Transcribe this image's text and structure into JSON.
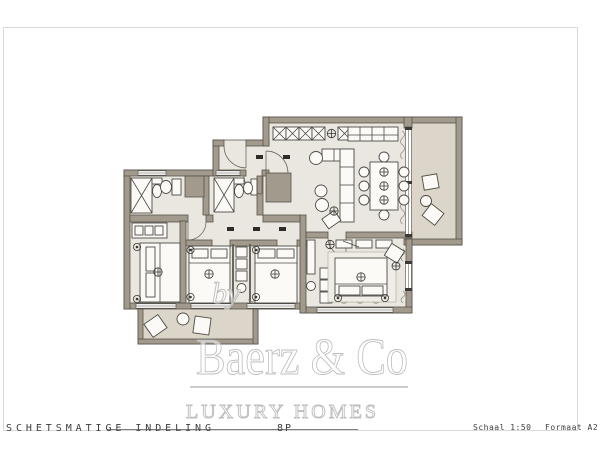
{
  "title_block": {
    "title": "SCHETSMATIGE INDELING",
    "capacity": "8P",
    "scale": "Schaal 1:50",
    "format": "Formaat A2"
  },
  "watermark": {
    "prefix": "by",
    "brand": "Baerz & Co",
    "tagline": "LUXURY HOMES"
  },
  "colors": {
    "wall": "#a29a8c",
    "wall-outline": "#57534b",
    "room": "#eae7e0",
    "terrace": "#dbd6c9",
    "furniture-fill": "#fbfaf7",
    "furniture-line": "#4e4b45",
    "detail-line": "#8a8578",
    "symbol": "#3b3934",
    "watermark": "#bcbcbc",
    "watermark-rule": "#9a9a9a",
    "text": "#3d3d3d",
    "frame": "#d9d9d9"
  }
}
